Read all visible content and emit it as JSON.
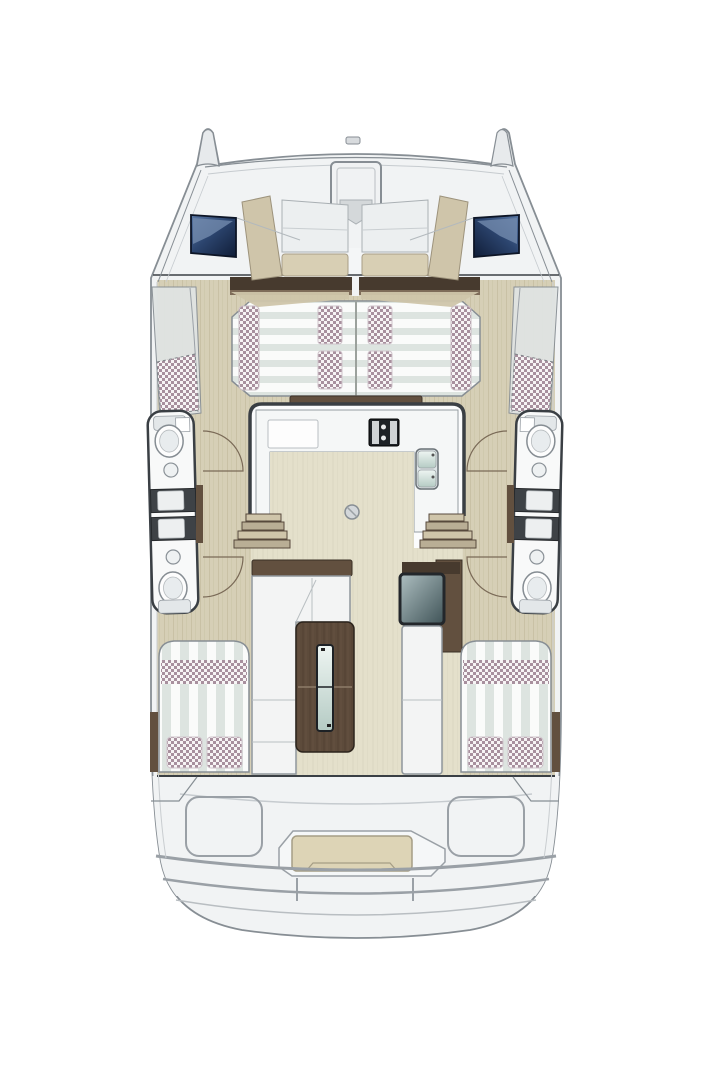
{
  "diagram": {
    "kind": "catamaran yacht deck floor plan",
    "view": "top-down",
    "text_labels": []
  },
  "colors": {
    "background": "#ffffff",
    "hull-fill": "#f1f3f4",
    "hull-shadow": "#e7eaec",
    "outline": "#878e94",
    "outline-dark": "#3a3f44",
    "beige-trim": "#cfc5aa",
    "beige-seat": "#d8cfb4",
    "wood-floor": "#d6cfb6",
    "wood-grain": "#c3bb9e",
    "pale-floor": "#e4e0cb",
    "pale-grain": "#d7d3bd",
    "brown-dark": "#473a2e",
    "brown-mid": "#62503f",
    "brown-table": "#5d4b3b",
    "window-blue-dark": "#101d37",
    "window-blue-light": "#5b79a6",
    "checker-dot": "#a8909e",
    "checker-base": "#f7f4f5",
    "stripe-light": "#fafbfa",
    "stripe-dark": "#dde4e0",
    "shower-dark": "#3e4246",
    "seat-white": "#f3f4f4",
    "glass-light": "#eef5f2",
    "glass-dark": "#b5cbc4",
    "nav-top-light": "#aebfc1",
    "nav-top-dark": "#3f5357",
    "bench-cushion": "#ddd4b6"
  },
  "features": [
    "bow-hatch",
    "forward-cockpit-seating",
    "port-bow-window",
    "starboard-bow-window",
    "forward-double-berth",
    "berth-pillows",
    "berth-bolsters",
    "bow-hull-cushions",
    "salon-galley",
    "stove",
    "double-sink",
    "galley-counter",
    "mast-foot",
    "port-forward-bathroom",
    "port-shower-stalls",
    "port-aft-bathroom",
    "starboard-forward-bathroom",
    "starboard-shower-stalls",
    "starboard-aft-bathroom",
    "companionway-steps",
    "salon-sofa",
    "salon-table",
    "nav-seat",
    "nav-table",
    "port-aft-berth",
    "starboard-aft-berth",
    "aft-deck-lockers",
    "aft-bench",
    "swim-platform"
  ]
}
